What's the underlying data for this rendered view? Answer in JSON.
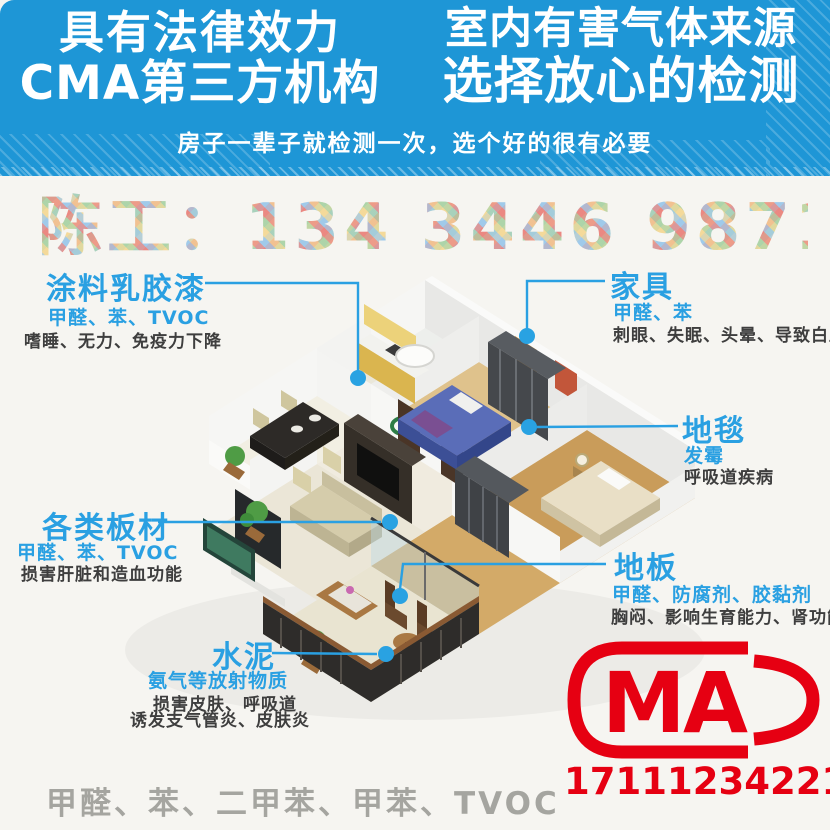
{
  "banner": {
    "left_line1": "具有法律效力",
    "left_line2": "CMA第三方机构",
    "right_line1": "室内有害气体来源",
    "right_line2": "选择放心的检测",
    "subtitle": "房子一辈子就检测一次，选个好的很有必要"
  },
  "contact": {
    "text": "陈工：134 3446 9871"
  },
  "callouts": {
    "paint": {
      "title": "涂料乳胶漆",
      "substances": "甲醛、苯、TVOC",
      "effects": "嗜睡、无力、免疫力下降"
    },
    "furniture": {
      "title": "家具",
      "substances": "甲醛、苯",
      "effects": "刺眼、失眠、头晕、导致白血病"
    },
    "carpet": {
      "title": "地毯",
      "substances": "发霉",
      "effects": "呼吸道疾病"
    },
    "boards": {
      "title": "各类板材",
      "substances": "甲醛、苯、TVOC",
      "effects": "损害肝脏和造血功能"
    },
    "floor": {
      "title": "地板",
      "substances": "甲醛、防腐剂、胶黏剂",
      "effects": "胸闷、影响生育能力、肾功能"
    },
    "cement": {
      "title": "水泥",
      "substances": "氨气等放射物质",
      "effects_line1": "损害皮肤、呼吸道",
      "effects_line2": "诱发支气管炎、皮肤炎"
    }
  },
  "footer": {
    "pollutants": "甲醛、苯、二甲苯、甲苯、TVOC",
    "cma_letters": "MA",
    "code": "171112342214"
  },
  "colors": {
    "banner_blue": "#1e96d6",
    "accent_blue": "#2aa0e2",
    "text_dark": "#3e3e3e",
    "gray_text": "#a5a5a0",
    "red": "#e60012"
  }
}
